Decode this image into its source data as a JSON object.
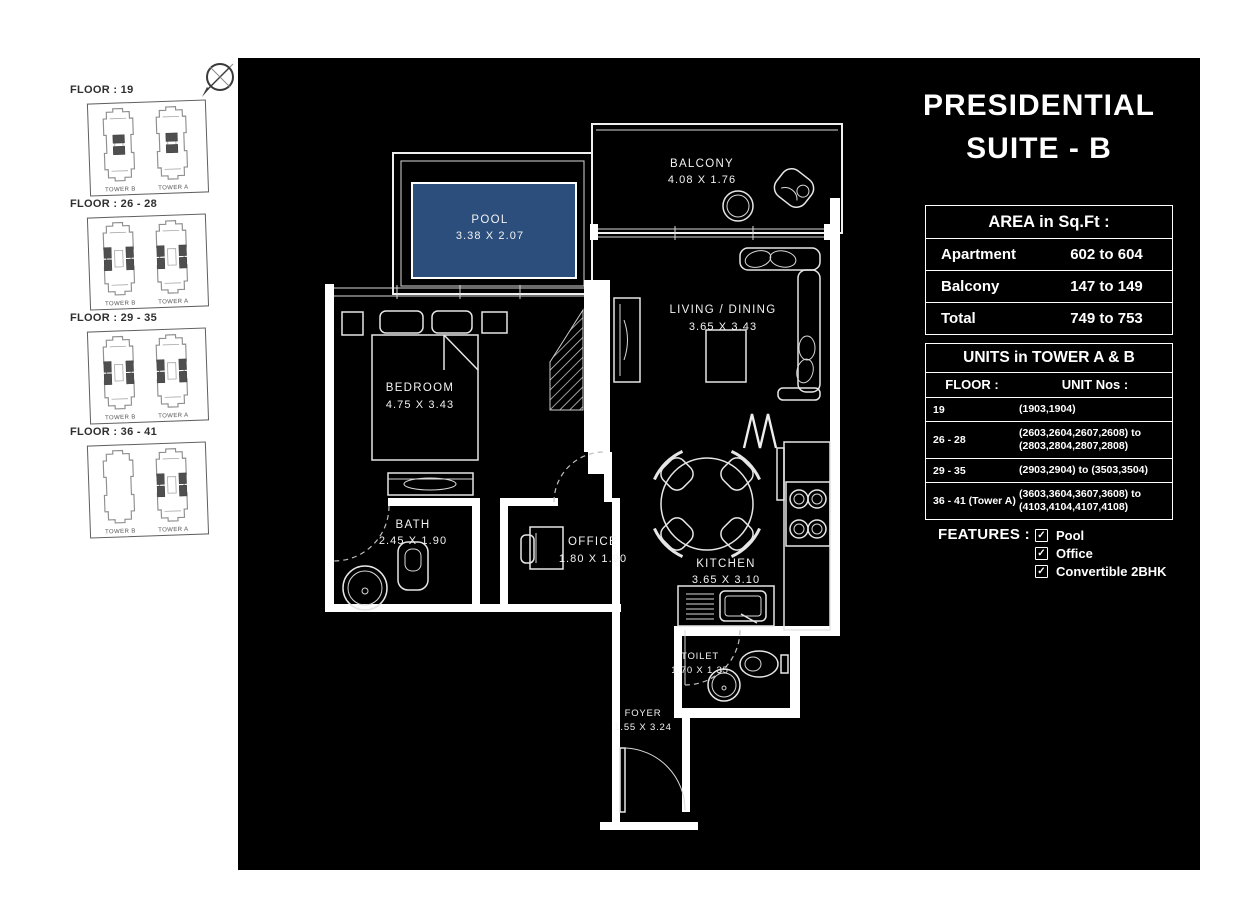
{
  "title": {
    "line1": "PRESIDENTIAL",
    "line2": "SUITE - B"
  },
  "sidebar": {
    "floors": [
      {
        "label": "FLOOR : 19",
        "towers": [
          {
            "name": "TOWER B",
            "variant": "core"
          },
          {
            "name": "TOWER A",
            "variant": "core"
          }
        ]
      },
      {
        "label": "FLOOR : 26 - 28",
        "towers": [
          {
            "name": "TOWER B",
            "variant": "wings"
          },
          {
            "name": "TOWER A",
            "variant": "wings"
          }
        ]
      },
      {
        "label": "FLOOR : 29 - 35",
        "towers": [
          {
            "name": "TOWER B",
            "variant": "wings"
          },
          {
            "name": "TOWER A",
            "variant": "wings"
          }
        ]
      },
      {
        "label": "FLOOR : 36 - 41",
        "towers": [
          {
            "name": "TOWER B",
            "variant": "none"
          },
          {
            "name": "TOWER A",
            "variant": "wings"
          }
        ]
      }
    ]
  },
  "plan": {
    "rooms": {
      "pool": {
        "name": "POOL",
        "dims": "3.38 X 2.07"
      },
      "balcony": {
        "name": "BALCONY",
        "dims": "4.08 X 1.76"
      },
      "living": {
        "name": "LIVING / DINING",
        "dims": "3.65 X 3.43"
      },
      "bedroom": {
        "name": "BEDROOM",
        "dims": "4.75 X 3.43"
      },
      "bath": {
        "name": "BATH",
        "dims": "2.45 X 1.90"
      },
      "office": {
        "name": "OFFICE",
        "dims": "1.80 X 1.90"
      },
      "kitchen": {
        "name": "KITCHEN",
        "dims": "3.65 X 3.10"
      },
      "toilet": {
        "name": "TOILET",
        "dims": "1.70 X 1.35"
      },
      "foyer": {
        "name": "FOYER",
        "dims": "1.55 X 3.24"
      }
    }
  },
  "colors": {
    "pool_fill": "#2C4E7C",
    "canvas_bg": "#000000",
    "line_white": "#ffffff"
  },
  "area_table": {
    "header": "AREA in Sq.Ft :",
    "rows": [
      {
        "label": "Apartment",
        "value": "602 to 604"
      },
      {
        "label": "Balcony",
        "value": "147 to 149"
      },
      {
        "label": "Total",
        "value": "749 to 753"
      }
    ]
  },
  "units_table": {
    "header": "UNITS in TOWER A & B",
    "col1": "FLOOR :",
    "col2": "UNIT Nos :",
    "rows": [
      {
        "floor": "19",
        "units": "(1903,1904)"
      },
      {
        "floor": "26 - 28",
        "units": "(2603,2604,2607,2608) to\n(2803,2804,2807,2808)"
      },
      {
        "floor": "29 - 35",
        "units": "(2903,2904) to (3503,3504)"
      },
      {
        "floor": "36 - 41 (Tower A)",
        "units": "(3603,3604,3607,3608) to\n(4103,4104,4107,4108)"
      }
    ]
  },
  "features": {
    "label": "FEATURES :",
    "check_glyph": "✓",
    "items": [
      "Pool",
      "Office",
      "Convertible 2BHK"
    ]
  }
}
